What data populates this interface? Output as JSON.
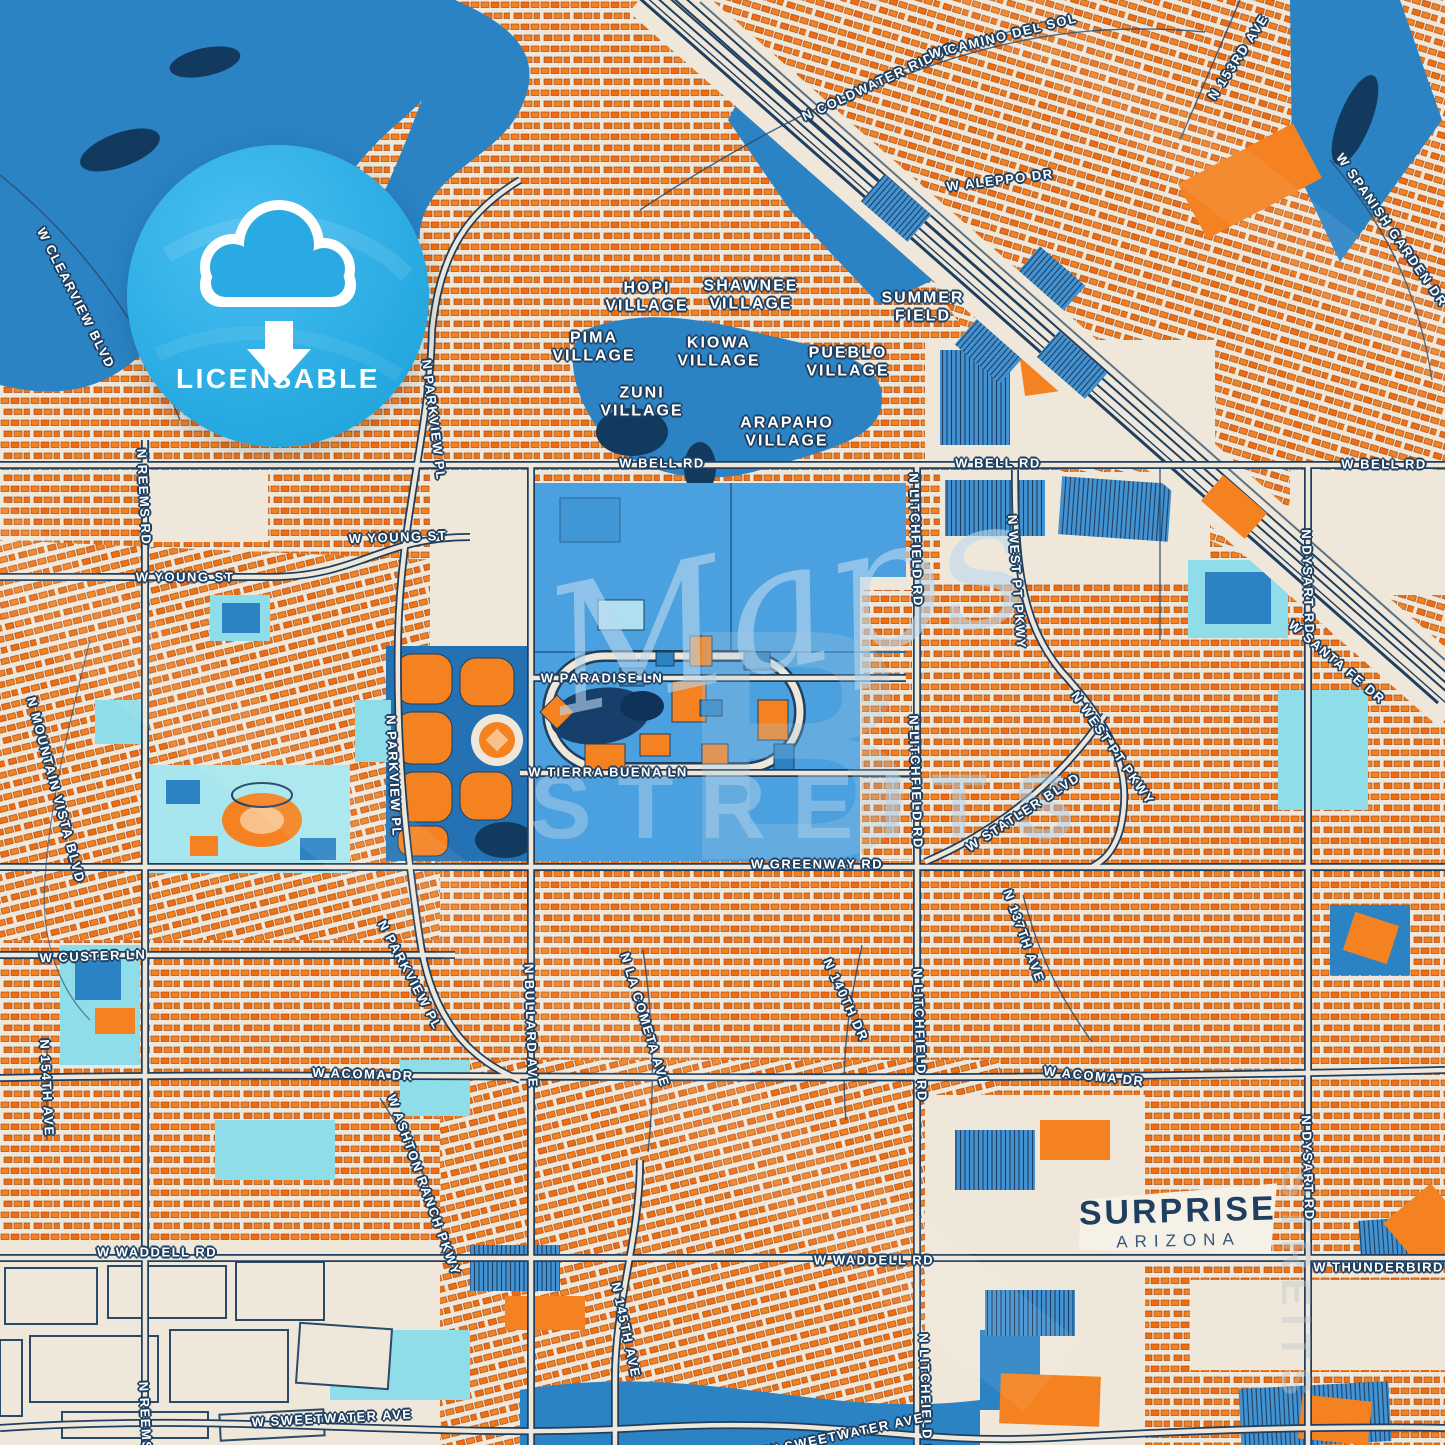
{
  "badge": {
    "label": "LICENSABLE",
    "icon": "cloud-download-icon"
  },
  "city_label": {
    "name": "SURPRISE",
    "state": "ARIZONA"
  },
  "watermark": {
    "script": "Maps",
    "letter": "B",
    "caps": "STREITS",
    "vertical": "STREITS"
  },
  "colors": {
    "cream": "#efe8da",
    "navy": "#1e3f60",
    "orange": "#f58220",
    "orange_dark": "#e2670d",
    "water_blue": "#2b83c4",
    "campus_blue": "#4ba1df",
    "teal": "#9fe4ec",
    "badge_blue": "#29abe2",
    "yellow": "#f6d645",
    "label_white": "#ffffff"
  },
  "villages": [
    {
      "t": "HOPI\nVILLAGE",
      "x": 647,
      "y": 297
    },
    {
      "t": "SHAWNEE\nVILLAGE",
      "x": 751,
      "y": 295
    },
    {
      "t": "SUMMER\nFIELD",
      "x": 923,
      "y": 307
    },
    {
      "t": "PIMA\nVILLAGE",
      "x": 594,
      "y": 347
    },
    {
      "t": "KIOWA\nVILLAGE",
      "x": 719,
      "y": 352
    },
    {
      "t": "PUEBLO\nVILLAGE",
      "x": 848,
      "y": 362
    },
    {
      "t": "ZUNI\nVILLAGE",
      "x": 642,
      "y": 402
    },
    {
      "t": "ARAPAHO\nVILLAGE",
      "x": 787,
      "y": 432
    }
  ],
  "streets": [
    {
      "t": "N COLDWATER RIDGE",
      "x": 878,
      "y": 82,
      "r": -25
    },
    {
      "t": "W CLEARVIEW BLVD",
      "x": 76,
      "y": 298,
      "r": 63
    },
    {
      "t": "W CAMINO DEL SOL",
      "x": 1003,
      "y": 36,
      "r": -14
    },
    {
      "t": "W ALEPPO DR",
      "x": 1000,
      "y": 180,
      "r": -7
    },
    {
      "t": "N 153RD AVE",
      "x": 1238,
      "y": 57,
      "r": -57
    },
    {
      "t": "W SPANISH GARDEN DR",
      "x": 1392,
      "y": 230,
      "r": 55
    },
    {
      "t": "W BELL RD",
      "x": 662,
      "y": 463,
      "r": 0
    },
    {
      "t": "W BELL RD",
      "x": 998,
      "y": 463,
      "r": 0
    },
    {
      "t": "W BELL RD",
      "x": 1384,
      "y": 464,
      "r": 0
    },
    {
      "t": "W YOUNG ST",
      "x": 398,
      "y": 537,
      "r": -2
    },
    {
      "t": "W YOUNG ST",
      "x": 185,
      "y": 577,
      "r": 0
    },
    {
      "t": "N PARKVIEW PL",
      "x": 434,
      "y": 420,
      "r": 83
    },
    {
      "t": "N REEMS RD",
      "x": 144,
      "y": 497,
      "r": 87
    },
    {
      "t": "W PARADISE LN",
      "x": 602,
      "y": 678,
      "r": 0
    },
    {
      "t": "W TIERRA BUENA LN",
      "x": 608,
      "y": 772,
      "r": 0
    },
    {
      "t": "N PARKVIEW PL",
      "x": 394,
      "y": 776,
      "r": 87
    },
    {
      "t": "N MOUNTAIN VISTA BLVD",
      "x": 56,
      "y": 790,
      "r": 75
    },
    {
      "t": "N LITCHFIELD RD",
      "x": 916,
      "y": 540,
      "r": 88
    },
    {
      "t": "N LITCHFIELD RD",
      "x": 916,
      "y": 782,
      "r": 88
    },
    {
      "t": "N WEST PT PKWY",
      "x": 1017,
      "y": 582,
      "r": 86
    },
    {
      "t": "N WEST PT PKWY",
      "x": 1113,
      "y": 748,
      "r": 55
    },
    {
      "t": "W STATLER BLVD",
      "x": 1023,
      "y": 812,
      "r": -33
    },
    {
      "t": "N DYSART RD",
      "x": 1308,
      "y": 582,
      "r": 88
    },
    {
      "t": "W SANTA FE DR",
      "x": 1337,
      "y": 662,
      "r": 40
    },
    {
      "t": "W GREENWAY RD",
      "x": 817,
      "y": 864,
      "r": 0
    },
    {
      "t": "W CUSTER LN",
      "x": 93,
      "y": 956,
      "r": -2
    },
    {
      "t": "N PARKVIEW PL",
      "x": 410,
      "y": 975,
      "r": 62
    },
    {
      "t": "N BULLARD AVE",
      "x": 531,
      "y": 1026,
      "r": 88
    },
    {
      "t": "N LA COMETA AVE",
      "x": 645,
      "y": 1020,
      "r": 73
    },
    {
      "t": "N 140TH DR",
      "x": 846,
      "y": 1000,
      "r": 65
    },
    {
      "t": "N 137TH AVE",
      "x": 1024,
      "y": 936,
      "r": 70
    },
    {
      "t": "N LITCHFIELD RD",
      "x": 920,
      "y": 1035,
      "r": 88
    },
    {
      "t": "W ACOMA DR",
      "x": 363,
      "y": 1074,
      "r": 2
    },
    {
      "t": "W ACOMA DR",
      "x": 1094,
      "y": 1076,
      "r": 6
    },
    {
      "t": "N 154TH AVE",
      "x": 47,
      "y": 1088,
      "r": 87
    },
    {
      "t": "W ASHTON RANCH PKWY",
      "x": 424,
      "y": 1185,
      "r": 70
    },
    {
      "t": "W WADDELL RD",
      "x": 157,
      "y": 1252,
      "r": 0
    },
    {
      "t": "W WADDELL RD",
      "x": 874,
      "y": 1260,
      "r": 0
    },
    {
      "t": "W THUNDERBIRD RD",
      "x": 1392,
      "y": 1267,
      "r": 0
    },
    {
      "t": "N DYSART RD",
      "x": 1308,
      "y": 1168,
      "r": 88
    },
    {
      "t": "N 145TH AVE",
      "x": 626,
      "y": 1330,
      "r": 78
    },
    {
      "t": "N LITCHFIELD RD",
      "x": 926,
      "y": 1400,
      "r": 88
    },
    {
      "t": "W SWEETWATER AVE",
      "x": 332,
      "y": 1418,
      "r": -3
    },
    {
      "t": "W SWEETWATER AVE",
      "x": 845,
      "y": 1434,
      "r": -12
    },
    {
      "t": "N REEMS RD",
      "x": 146,
      "y": 1430,
      "r": 87
    }
  ]
}
